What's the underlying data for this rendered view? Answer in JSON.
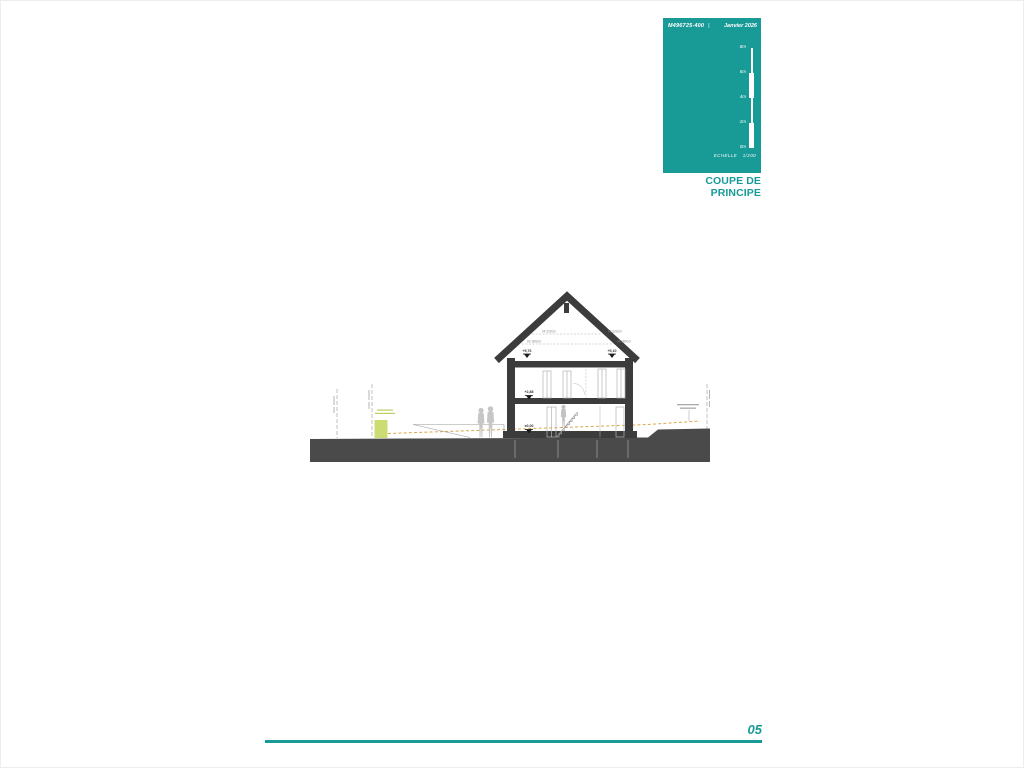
{
  "title_block": {
    "ref": "M496725-400",
    "separator": "|",
    "date": "Janvier 2026",
    "scale_ticks": [
      "8m",
      "6m",
      "4m",
      "2m",
      "0m"
    ],
    "scale_label": "ECHELLE",
    "scale_value": "1/200",
    "title": "COUPE DE PRINCIPE",
    "accent_color": "#189a97"
  },
  "drawing": {
    "levels": [
      "+5,76",
      "+5,10",
      "+2,88",
      "±0,00"
    ],
    "attic_heights": [
      "Ht 220cm",
      "Ht 180cm",
      "Ht 220cm",
      "Ht 180cm"
    ],
    "colors": {
      "structure": "#3c3c3c",
      "ground": "#4a4a4a",
      "terrain_line": "#d8a84e",
      "hedge": "#ccdc73"
    }
  },
  "footer": {
    "page_number": "05"
  }
}
